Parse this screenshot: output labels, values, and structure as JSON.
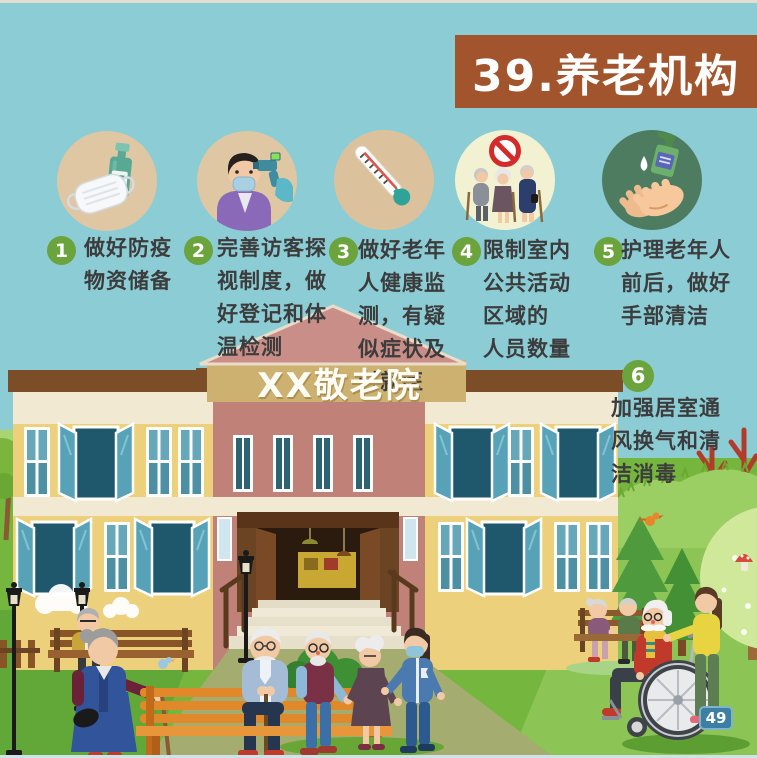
{
  "poster": {
    "banner_title": "39.养老机构",
    "building_sign": "XX敬老院",
    "page_number": "49"
  },
  "tips": [
    {
      "num": "1",
      "text": "做好防疫\n物资储备",
      "icon": "face-mask-and-sanitizer-bottle"
    },
    {
      "num": "2",
      "text": "完善访客探\n视制度，做\n好登记和体\n温检测",
      "icon": "visitor-temperature-check"
    },
    {
      "num": "3",
      "text": "做好老年\n人健康监\n测，有疑\n似症状及\n时就医",
      "icon": "thermometer"
    },
    {
      "num": "4",
      "text": "限制室内\n公共活动\n区域的\n人员数量",
      "icon": "limit-indoor-crowd"
    },
    {
      "num": "5",
      "text": "护理老年人\n前后，做好\n手部清洁",
      "icon": "hand-hygiene"
    },
    {
      "num": "6",
      "text": "加强居室通\n风换气和清\n洁消毒",
      "icon": "none"
    }
  ],
  "colors": {
    "background": "#8ccdd5",
    "banner": "#a2552c",
    "tip_number_green": "#6ba33d",
    "page_badge_blue": "#3d7fa2",
    "icon_circle_tan": "#dfc7a3",
    "icon_circle_cream": "#f2f2d2",
    "icon_circle_dark_green": "#4d7c60",
    "building_yellow": "#ecd07c",
    "building_pink": "#c08178",
    "lawn_green": "#74b63e"
  }
}
